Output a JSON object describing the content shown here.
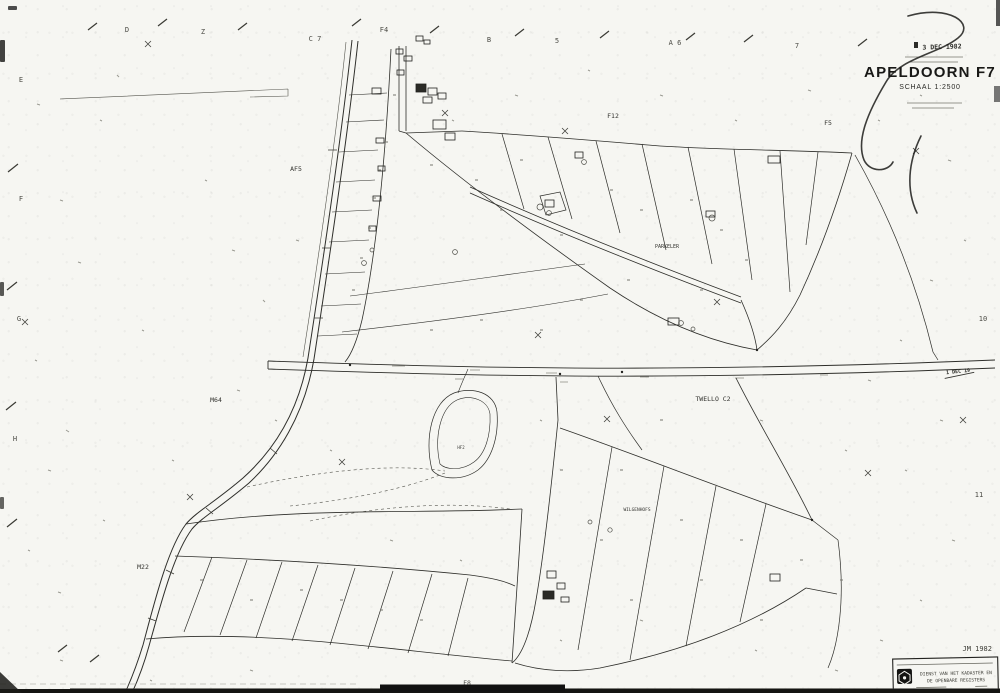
{
  "sheet": {
    "paper_color": "#f6f6f2",
    "ink_color": "#2e2e2a"
  },
  "title_block": {
    "date_stamp": "3 DEC 1982",
    "title": "APELDOORN F7",
    "scale": "SCHAAL 1:2500"
  },
  "margins": {
    "top": [
      "D",
      "Z",
      "C 7",
      "F4",
      "B",
      "5",
      "A 6",
      "7"
    ],
    "left": [
      "E",
      "F",
      "G",
      "H"
    ],
    "right": [
      "10",
      "11"
    ],
    "bottom": [
      "F8"
    ]
  },
  "map_labels": {
    "af5": "AF5",
    "f12": "F12",
    "f5": "F5",
    "m64": "M64",
    "twello": "TWELLO C2",
    "parkeler": "PARKELER",
    "m22": "M22",
    "hf2": "HF2",
    "wilgenhofs": "WILGENHOFS"
  },
  "edge_stamp": {
    "text": "1 DEC 19"
  },
  "footer": {
    "year_note": "JM 1982",
    "agency_line1": "DIENST VAN HET KADASTER EN",
    "agency_line2": "DE OPENBARE REGISTERS"
  }
}
